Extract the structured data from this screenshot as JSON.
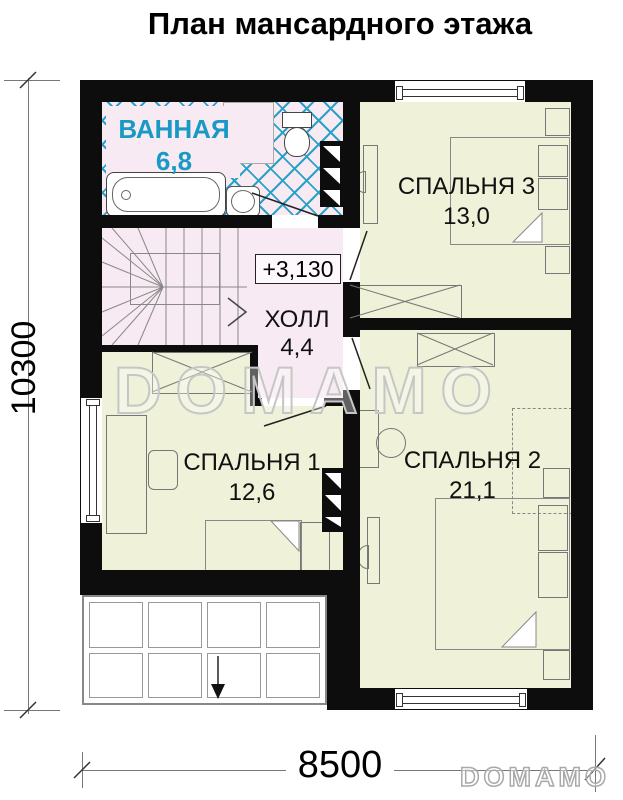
{
  "title": "План мансардного этажа",
  "dimensions": {
    "overall_height": "10300",
    "overall_width": "8500"
  },
  "elevation_mark": "+3,130",
  "rooms": [
    {
      "name": "ВАННАЯ",
      "area": "6,8"
    },
    {
      "name": "СПАЛЬНЯ 3",
      "area": "13,0"
    },
    {
      "name": "ХОЛЛ",
      "area": "4,4"
    },
    {
      "name": "СПАЛЬНЯ 1",
      "area": "12,6"
    },
    {
      "name": "СПАЛЬНЯ 2",
      "area": "21,1"
    }
  ],
  "watermarks": {
    "center": "DOMAMO",
    "corner": "DOMAMO"
  },
  "colors": {
    "wall": "#0d0d0d",
    "zone_pink": "#f7eaf2",
    "zone_green": "#eff1d8",
    "tile_blue": "#2aa2c8",
    "bathroom_text": "#189ac4"
  }
}
